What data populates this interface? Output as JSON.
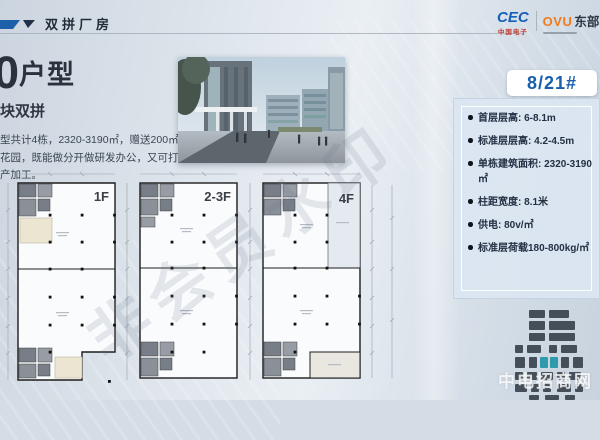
{
  "header": {
    "title": "双拼厂房"
  },
  "brand": {
    "cec": "CEC",
    "cec_sub": "中国电子",
    "ovu": "OVU",
    "ovu_name": "东部"
  },
  "intro": {
    "number": "0",
    "number_suffix": "户型",
    "subtitle": "块双拼",
    "desc_lines": [
      "型共计4栋，2320-3190㎡，赠送200㎡",
      "花园，既能做分开做研发办公，又可打通",
      "产加工。"
    ]
  },
  "unit_badge": {
    "label": "8/21#"
  },
  "specs": {
    "items": [
      "首层层高: 6-8.1m",
      "标准层层高: 4.2-4.5m",
      "单栋建筑面积: 2320-3190 ㎡",
      "柱距宽度: 8.1米",
      "供电: 80v/㎡",
      "标准层荷载180-800kg/㎡"
    ]
  },
  "floorplans": {
    "plan1_label": "1F",
    "plan2_label": "2-3F",
    "plan3_label": "4F"
  },
  "watermarks": {
    "diagonal": "非会员水印",
    "corner": "中电招商网"
  },
  "colors": {
    "accent_blue": "#1a5fae",
    "cec_blue": "#1460b8",
    "cec_red": "#c23b2e",
    "ovu_orange": "#f07a1d",
    "teal_highlight": "#2f9aac",
    "panel_bg": "#dbe6f2",
    "slide_bg": "#d4dde6",
    "plan_fill": "#fafbfd",
    "beige_room": "#ece5d2"
  }
}
